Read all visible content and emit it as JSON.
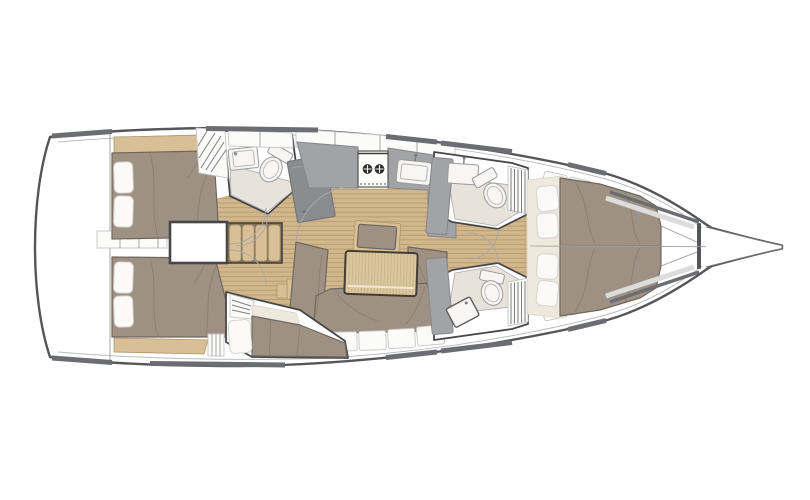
{
  "scene": {
    "background": "#ffffff",
    "view": "yacht-deck-floorplan",
    "orientation": "bow-right"
  },
  "colors": {
    "page_bg": "#ffffff",
    "hull_outline": "#55565a",
    "hull_inner_line": "#bcbdbf",
    "wood_floor": "#d3b78c",
    "wood_floor_line": "#b89c72",
    "wood_trim": "#d9bf95",
    "table_wood": "#dbc79e",
    "table_border": "#423a32",
    "upholstery": "#9e9184",
    "upholstery_shadow": "#857a6e",
    "pillow": "#fbfaf8",
    "cream_cushion": "#efe8dd",
    "counter_gray": "#a2a3a4",
    "chart_table_gray": "#8b8c8d",
    "fixture_white": "#f7f6f4",
    "bath_floor": "#e7e2da",
    "hatch_dark": "#6b6d70",
    "window_band": "#dcdcdc",
    "wall_line": "#46474a"
  },
  "parts": [
    "hull",
    "swim-platform",
    "aft-cabin-port",
    "aft-cabin-starboard",
    "engine-box",
    "companionway-stairs",
    "head-aft-port",
    "chart-table",
    "galley",
    "stove",
    "galley-sink",
    "salon",
    "salon-table",
    "salon-settee",
    "mid-cabin-starboard",
    "head-forward-port",
    "head-forward-starboard",
    "forward-cabin",
    "island-berth",
    "anchor-locker",
    "bowsprit"
  ]
}
